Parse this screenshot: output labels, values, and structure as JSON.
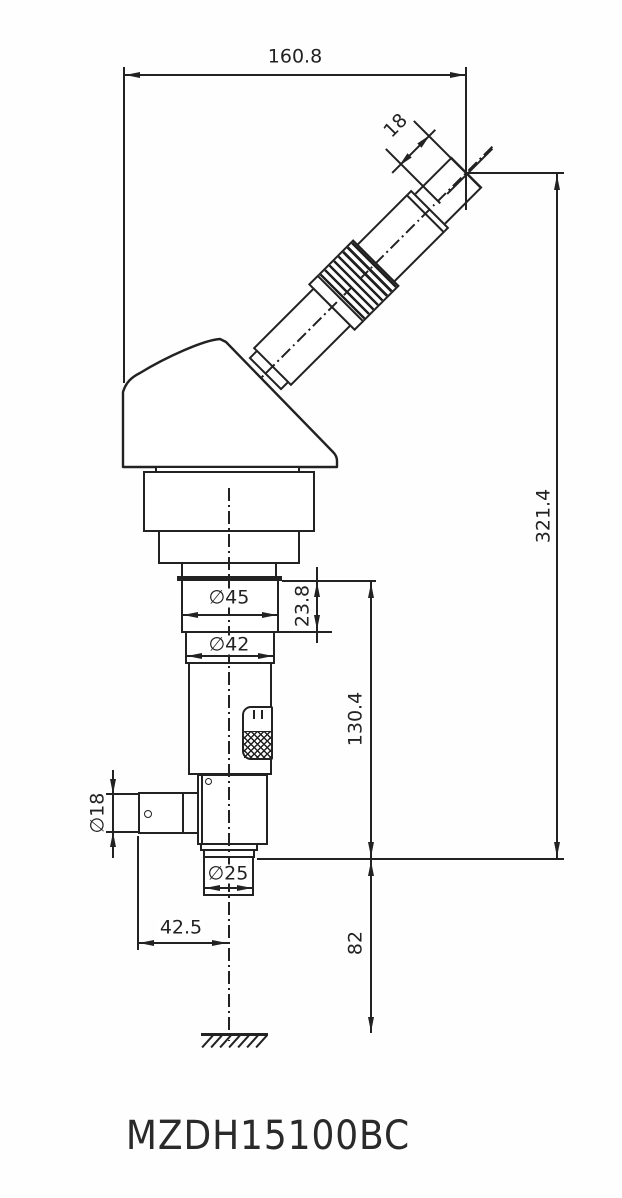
{
  "drawing": {
    "model": "MZDH15100BC",
    "dimensions": {
      "top_width": "160.8",
      "eyepiece_tube": "18",
      "overall_height": "321.4",
      "mount_ring_dia": "∅45",
      "mount_ring_height": "23.8",
      "barrel_dia": "∅42",
      "body_height": "130.4",
      "side_port_dia": "∅18",
      "nosepiece_dia": "∅25",
      "port_axis_offset": "42.5",
      "working_height": "82"
    },
    "colors": {
      "line": "#222222",
      "background": "#ffffff"
    }
  }
}
